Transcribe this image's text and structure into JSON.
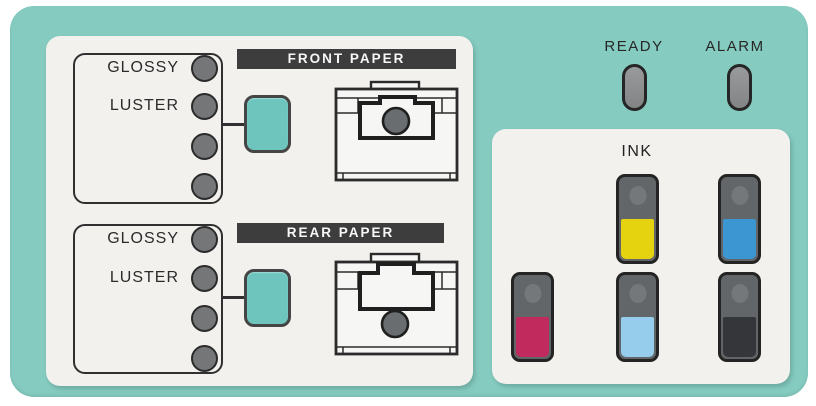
{
  "colors": {
    "board_teal": "#85cbc0",
    "panel_surface": "#f2f1ee",
    "button_teal": "#6dc5be",
    "banner_dark": "#3d3d3d"
  },
  "status_lamps": {
    "ready_label": "READY",
    "alarm_label": "ALARM"
  },
  "paper_sections": {
    "front": {
      "banner_label": "FRONT PAPER",
      "media_options": [
        "GLOSSY",
        "LUSTER"
      ],
      "lamp_count": 4
    },
    "rear": {
      "banner_label": "REAR PAPER",
      "media_options": [
        "GLOSSY",
        "LUSTER"
      ],
      "lamp_count": 4
    }
  },
  "ink_panel": {
    "title": "INK",
    "cartridges": [
      {
        "name": "magenta",
        "color": "#c02a5c"
      },
      {
        "name": "yellow",
        "color": "#e5d30f"
      },
      {
        "name": "light-blue",
        "color": "#96cdec"
      },
      {
        "name": "blue",
        "color": "#3b96d2"
      },
      {
        "name": "black",
        "color": "#343639"
      }
    ]
  }
}
